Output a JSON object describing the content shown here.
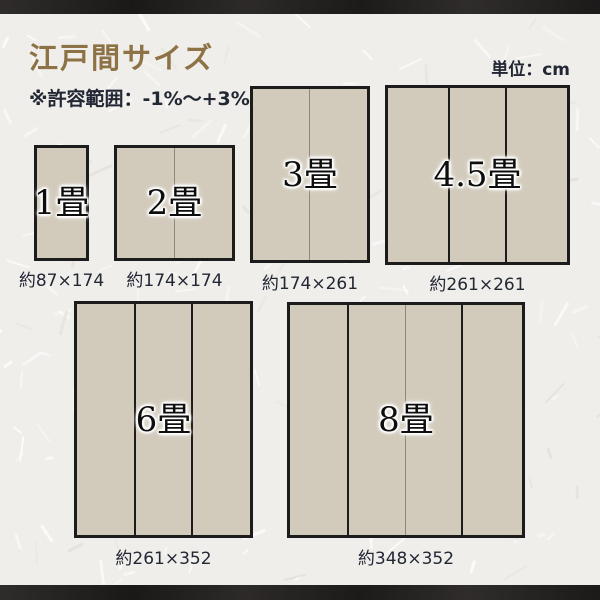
{
  "header": {
    "title": "江戸間サイズ",
    "tolerance_note": "※許容範囲：-1%〜+3%",
    "unit_label": "単位：cm"
  },
  "mats": [
    {
      "id": "1jo",
      "label": "1畳",
      "dimensions": "約87×174"
    },
    {
      "id": "2jo",
      "label": "2畳",
      "dimensions": "約174×174"
    },
    {
      "id": "3jo",
      "label": "3畳",
      "dimensions": "約174×261"
    },
    {
      "id": "45jo",
      "label": "4.5畳",
      "dimensions": "約261×261"
    },
    {
      "id": "6jo",
      "label": "6畳",
      "dimensions": "約261×352"
    },
    {
      "id": "8jo",
      "label": "8畳",
      "dimensions": "約348×352"
    }
  ],
  "colors": {
    "title_accent": "#8c7245",
    "text_dark": "#222734",
    "tatami_fill": "#d2cbbc",
    "tatami_border": "#1c1c1c",
    "seam_thin": "#8b887d",
    "frame_bar": "#242120",
    "background": "#f0eeea"
  }
}
